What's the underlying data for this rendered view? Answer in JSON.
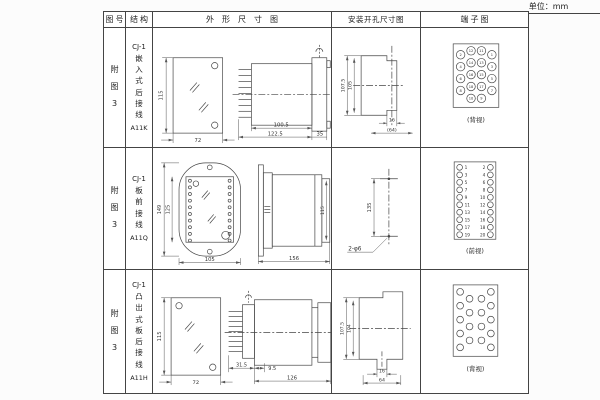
{
  "page": {
    "unit_label": "单位：mm"
  },
  "header": {
    "figure": "图号",
    "structure": "结构",
    "outline": "外形尺寸图",
    "mounting": "安装开孔尺寸图",
    "terminal": "端子图"
  },
  "rows": [
    {
      "figure": "附图3",
      "model": "CJ-1",
      "mount_type": "嵌入式后接线",
      "code": "A11K",
      "outline_dims": {
        "height": "115",
        "width": "72",
        "body": "100.5",
        "total": "122.5",
        "flange": "35"
      },
      "mounting_dims": {
        "outer": "107.5",
        "inner": "105",
        "slot": "16",
        "width": "(64)"
      },
      "terminal": {
        "caption": "(背视)",
        "numbers": [
          "2",
          "12",
          "11",
          "1",
          "4",
          "14",
          "13",
          "3",
          "6",
          "16",
          "15",
          "5",
          "8",
          "18",
          "17",
          "7",
          "10",
          "9"
        ]
      }
    },
    {
      "figure": "附图3",
      "model": "CJ-1",
      "mount_type": "板前接线",
      "code": "A11Q",
      "outline_dims": {
        "height": "149",
        "window": "125",
        "width": "105",
        "depth": "156",
        "side_height": "115"
      },
      "mounting_dims": {
        "spacing": "135",
        "holes": "2-φ6"
      },
      "terminal": {
        "caption": "(前视)",
        "left": [
          "1",
          "3",
          "5",
          "7",
          "9",
          "11",
          "13",
          "15",
          "17",
          "19"
        ],
        "right": [
          "2",
          "4",
          "6",
          "8",
          "10",
          "12",
          "14",
          "16",
          "18",
          "20"
        ]
      }
    },
    {
      "figure": "附图3",
      "model": "CJ-1",
      "mount_type": "凸出式板后接线",
      "code": "A11H",
      "outline_dims": {
        "height": "115",
        "width": "72",
        "pins": "31.5",
        "offset": "9.5",
        "depth": "126"
      },
      "mounting_dims": {
        "outer": "107.5",
        "inner": "104",
        "slot": "16",
        "width": "64"
      },
      "terminal": {
        "caption": "(背视)"
      }
    }
  ]
}
